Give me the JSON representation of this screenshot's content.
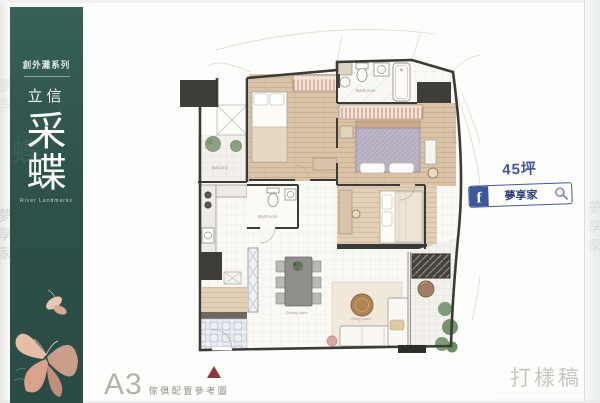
{
  "sidebar": {
    "series_label": "創外灘系列",
    "brand": "立信",
    "title_char_1": "采",
    "title_char_2": "蝶",
    "subtitle_en": "River Landmarks"
  },
  "plan": {
    "labels": {
      "balcony_top": "Balcony",
      "bathroom_top": "Bathroom",
      "bathroom_mid": "Bathroom",
      "dining": "Dining room",
      "living": "Living room",
      "planting": "Planting"
    }
  },
  "annotation": {
    "area_label": "45坪",
    "fb_letter": "f",
    "fb_page_name": "夢享家"
  },
  "footer": {
    "plan_code": "A3",
    "plan_caption": "傢俱配置參考圖",
    "proof_label": "打樣稿",
    "fine_print": "··········································"
  },
  "watermarks": {
    "left_upper": "夢享",
    "left_lower": "夢享家",
    "right": "夢享家"
  },
  "colors": {
    "sidebar_bg": "#2f564e",
    "accent_blue": "#44589e",
    "fb_blue": "#3b5998",
    "wall": "#3b3a36",
    "wood_floor": "#d9c2a6",
    "wardrobe_hatch": "#bf7569",
    "proof_gray": "#c7c5c1",
    "north_arrow": "#8a3b39"
  }
}
